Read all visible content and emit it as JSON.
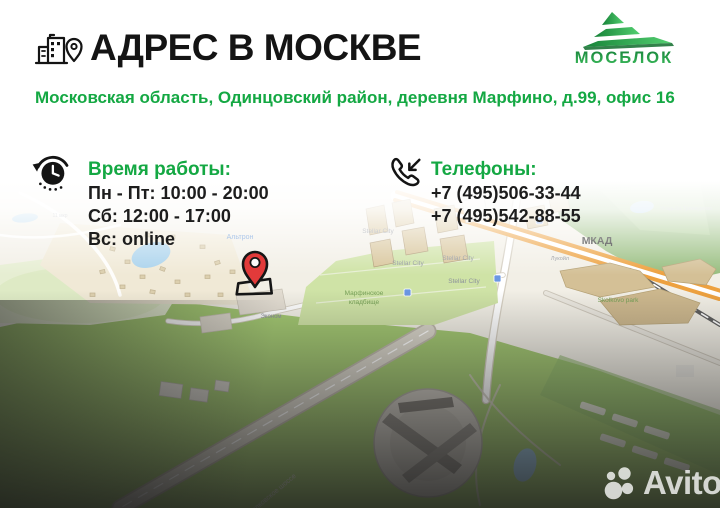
{
  "theme": {
    "accent_green": "#14a843",
    "logo_green_dark": "#168238",
    "logo_green_light": "#53cf70",
    "pin_red": "#e23a3a",
    "title_color": "#141414"
  },
  "header": {
    "title": "АДРЕС В МОСКВЕ"
  },
  "logo": {
    "name": "МОСБЛОК"
  },
  "address": {
    "text": "Московская область, Одинцовский район, деревня Марфино, д.99, офис 16"
  },
  "hours": {
    "title": "Время работы:",
    "lines": [
      "Пн - Пт: 10:00 - 20:00",
      "Сб: 12:00 - 17:00",
      "Вс: online"
    ]
  },
  "phones": {
    "title": "Телефоны:",
    "numbers": [
      "+7 (495)506-33-44",
      "+7 (495)542-88-55"
    ]
  },
  "map": {
    "labels": [
      {
        "id": "altron",
        "text": "Альтрон",
        "x": 240,
        "y": 64,
        "size": 7,
        "cls": "lbl-blue"
      },
      {
        "id": "mkr",
        "text": "11 мкр",
        "x": 60,
        "y": 42,
        "size": 5,
        "cls": "lbl-faint"
      },
      {
        "id": "stellar-1",
        "text": "Stellar City",
        "x": 378,
        "y": 58,
        "size": 6.5,
        "cls": "lbl-gray"
      },
      {
        "id": "stellar-2",
        "text": "Stellar City",
        "x": 408,
        "y": 90,
        "size": 6.5,
        "cls": "lbl-gray"
      },
      {
        "id": "stellar-3",
        "text": "Stellar City",
        "x": 458,
        "y": 85,
        "size": 6.5,
        "cls": "lbl-gray"
      },
      {
        "id": "stellar-4",
        "text": "Stellar City",
        "x": 464,
        "y": 108,
        "size": 6.5,
        "cls": "lbl-gray"
      },
      {
        "id": "econom",
        "text": "Эконом",
        "x": 271,
        "y": 143,
        "size": 6,
        "cls": "lbl-gray"
      },
      {
        "id": "cemetery-1",
        "text": "Марфинское",
        "x": 364,
        "y": 120,
        "size": 6.5,
        "cls": "lbl-green"
      },
      {
        "id": "cemetery-2",
        "text": "кладбище",
        "x": 364,
        "y": 129,
        "size": 6.5,
        "cls": "lbl-green"
      },
      {
        "id": "mkad",
        "text": "МКАД",
        "x": 597,
        "y": 69,
        "size": 10.5,
        "cls": "lbl-dark"
      },
      {
        "id": "lukoil",
        "text": "Лукойл",
        "x": 560,
        "y": 85,
        "size": 5.5,
        "cls": "lbl-gray"
      },
      {
        "id": "skolkovo-park",
        "text": "Skolkovo park",
        "x": 618,
        "y": 127,
        "size": 6.5,
        "cls": "lbl-green"
      },
      {
        "id": "usadba",
        "text": "Усадьба Троекурово",
        "x": 686,
        "y": 35,
        "size": 5.5,
        "cls": "lbl-faint"
      },
      {
        "id": "highway",
        "text": "Сколковское шоссе",
        "x": 272,
        "y": 322,
        "size": 7,
        "cls": "lbl-road",
        "rot": -40
      }
    ]
  },
  "watermark": {
    "text": "Avito"
  }
}
